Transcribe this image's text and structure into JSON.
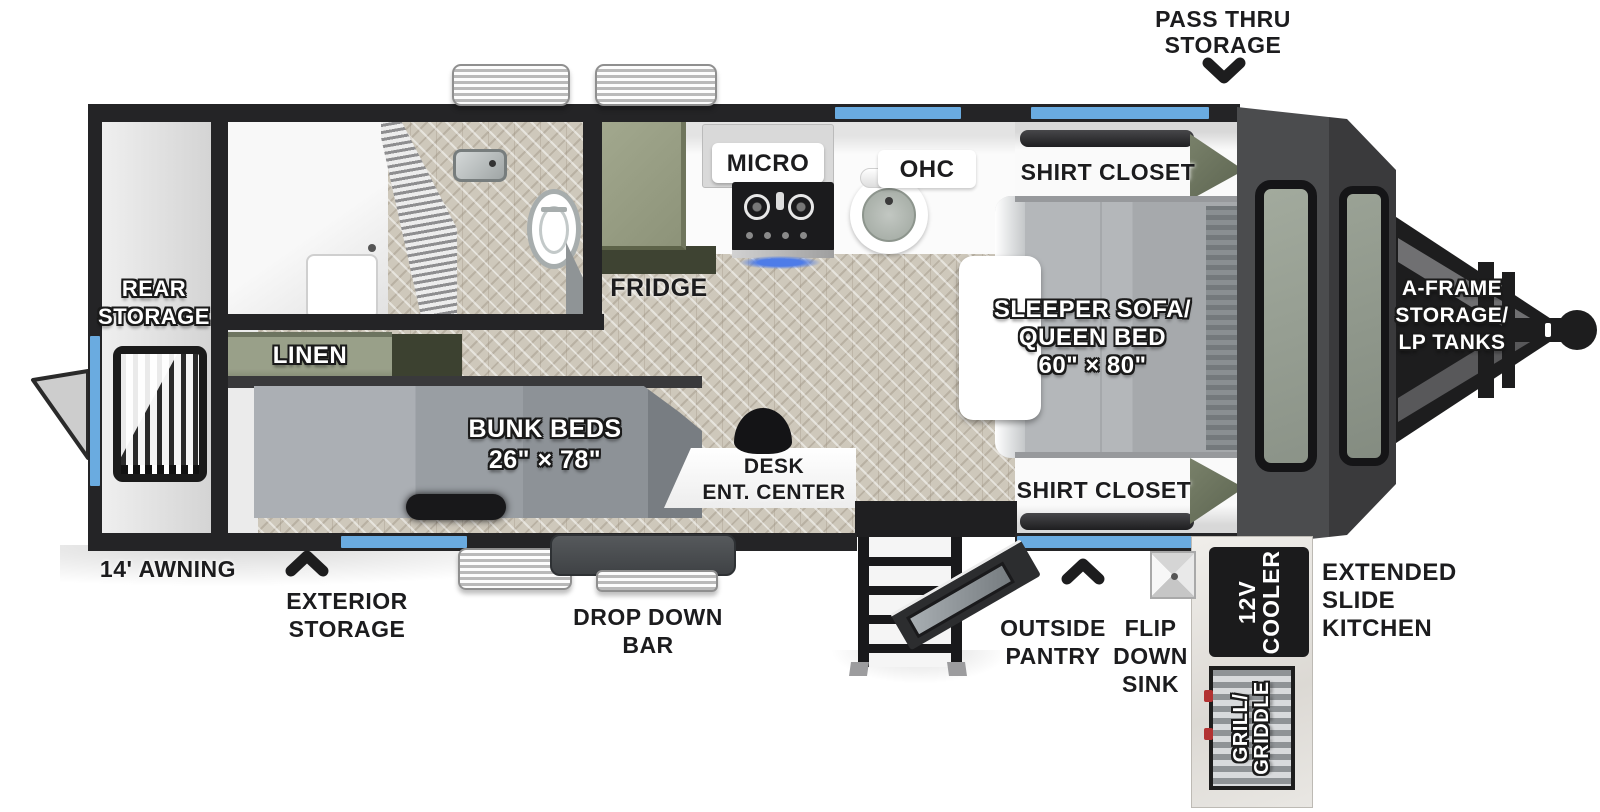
{
  "title": "Travel trailer floor plan",
  "colors": {
    "wall": "#242426",
    "window_blue": "#6aabe0",
    "floor_tile": "#cec8bb",
    "cabinet_sage": "#99a089",
    "cabinet_olive": "#6e755c",
    "front_cap": "#4b4c4e",
    "hitch_black": "#1d1d1e",
    "label_black": "#1c1c1e",
    "label_white": "#ffffff"
  },
  "labels": {
    "pass_thru_1": "PASS THRU",
    "pass_thru_2": "STORAGE",
    "rear_storage_1": "REAR",
    "rear_storage_2": "STORAGE",
    "linen": "LINEN",
    "fridge": "FRIDGE",
    "micro": "MICRO",
    "ohc": "OHC",
    "shirt_closet_top": "SHIRT CLOSET",
    "shirt_closet_bottom": "SHIRT CLOSET",
    "sleeper_1": "SLEEPER SOFA/",
    "sleeper_2": "QUEEN BED",
    "sleeper_3": "60\" × 80\"",
    "bunk_1": "BUNK BEDS",
    "bunk_2": "26\" × 78\"",
    "desk_1": "DESK",
    "desk_2": "ENT. CENTER",
    "aframe_1": "A-FRAME",
    "aframe_2": "STORAGE/",
    "aframe_3": "LP TANKS",
    "awning": "14' AWNING",
    "exterior_storage_1": "EXTERIOR",
    "exterior_storage_2": "STORAGE",
    "drop_down_1": "DROP DOWN",
    "drop_down_2": "BAR",
    "outside_pantry_1": "OUTSIDE",
    "outside_pantry_2": "PANTRY",
    "flip_sink_1": "FLIP",
    "flip_sink_2": "DOWN",
    "flip_sink_3": "SINK",
    "cooler_1": "12V",
    "cooler_2": "COOLER",
    "extended_1": "EXTENDED",
    "extended_2": "SLIDE",
    "extended_3": "KITCHEN",
    "grill_1": "GRILL/",
    "grill_2": "GRIDDLE"
  }
}
